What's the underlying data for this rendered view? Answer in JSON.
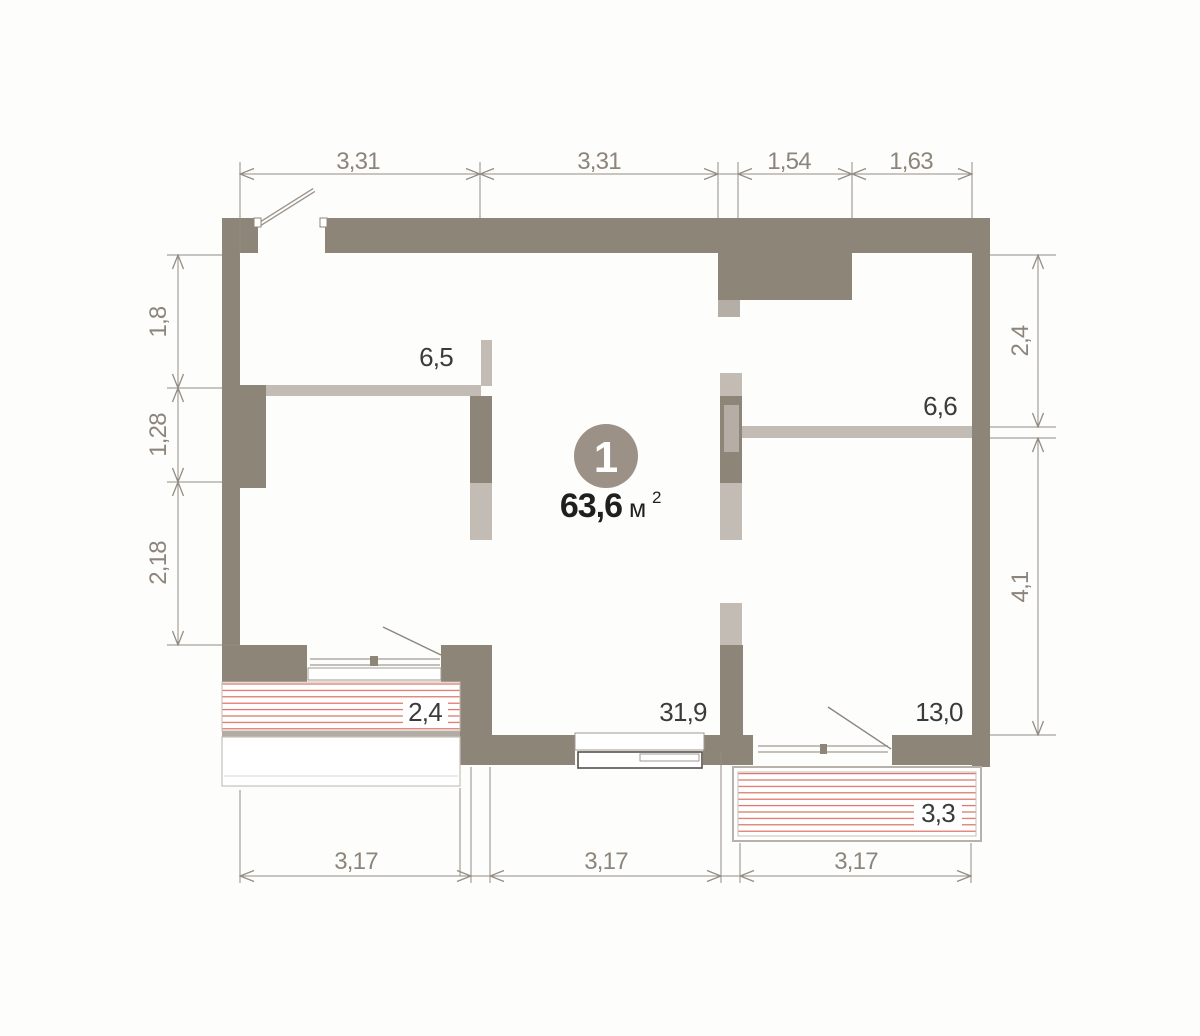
{
  "plan": {
    "unit": {
      "number": "1",
      "area_value": "63,6",
      "area_unit": "м",
      "area_sup": "2"
    },
    "rooms": {
      "top_left": "6,5",
      "top_right": "6,6",
      "living": "31,9",
      "bottom_right": "13,0",
      "balcony_left": "2,4",
      "balcony_right": "3,3"
    },
    "dims": {
      "top": [
        "3,31",
        "3,31",
        "1,54",
        "1,63"
      ],
      "left": [
        "1,8",
        "1,28",
        "2,18"
      ],
      "right": [
        "2,4",
        "4,1"
      ],
      "bottom": [
        "3,17",
        "3,17",
        "3,17"
      ]
    },
    "colors": {
      "wall_dark": "#8e8579",
      "wall_light": "#c2bcb4",
      "hatch_red": "#d96352",
      "dimension": "#948d83",
      "badge": "#9b9187",
      "label_text": "#3b3b3b"
    }
  }
}
